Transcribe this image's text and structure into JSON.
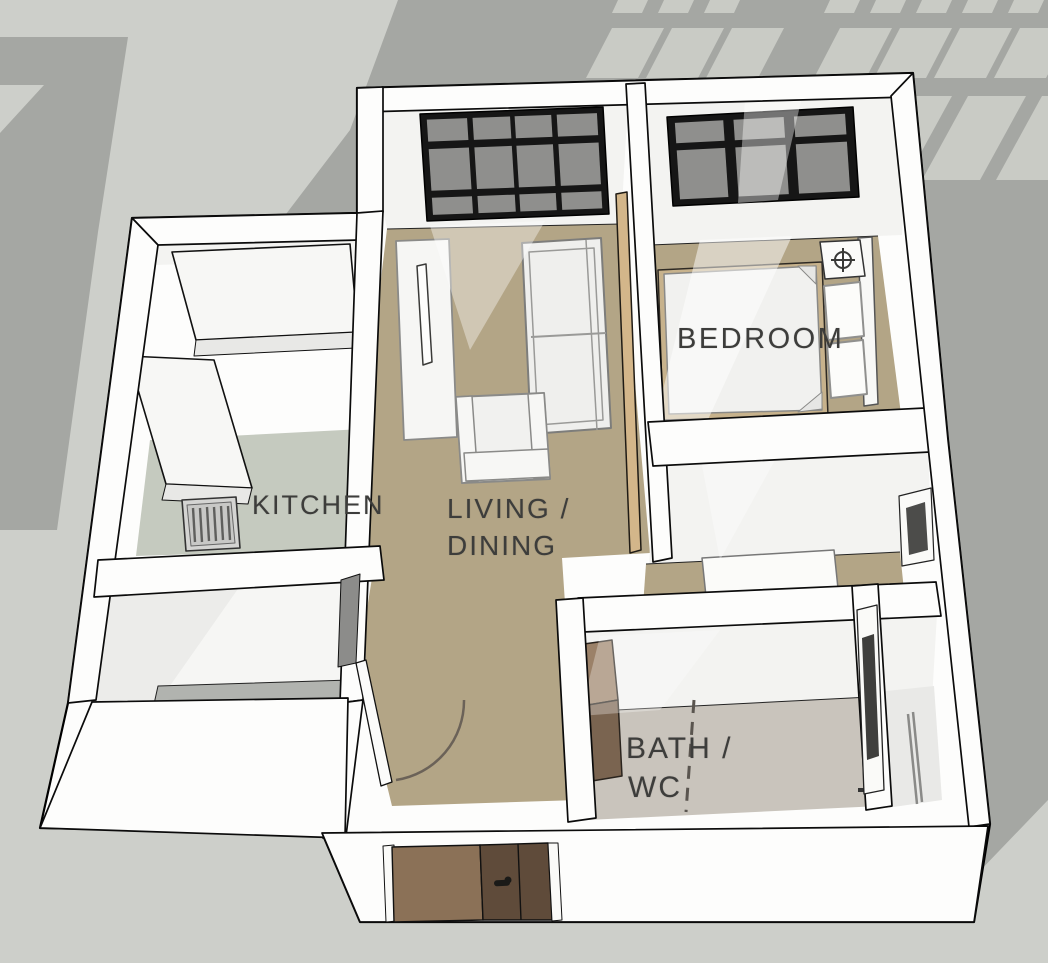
{
  "labels": {
    "kitchen": "KITCHEN",
    "living_line1": "LIVING /",
    "living_line2": "DINING",
    "bedroom": "BEDROOM",
    "bath_line1": "BATH /",
    "bath_line2": "WC"
  },
  "colors": {
    "background": "#cdcfca",
    "shadow_gray": "#a5a7a3",
    "slash_light": "#c9cbc5",
    "wall_white": "#fdfdfc",
    "wall_face": "#f3f3f1",
    "floor_living": "#b3a586",
    "floor_bedroom": "#b3a586",
    "floor_hall": "#b3a586",
    "floor_kitchen": "#c5cabf",
    "floor_bath": "#c9c4bc",
    "window_frame": "#161616",
    "window_glass": "#8f8f8d",
    "door_leaf_light": "#8b7157",
    "door_leaf_dark": "#5f4b3a",
    "sliding_door_wood": "#d3b68a",
    "vanity_wood_top": "#9b8168",
    "vanity_wood_side": "#7a6450",
    "label_text": "#3d3d3b"
  },
  "windows": {
    "living": {
      "corners": [
        [
          420,
          114
        ],
        [
          603,
          107
        ],
        [
          609,
          214
        ],
        [
          427,
          221
        ]
      ],
      "cols": [
        [
          0.035,
          0.255
        ],
        [
          0.285,
          0.49
        ],
        [
          0.515,
          0.715
        ],
        [
          0.745,
          0.965
        ]
      ],
      "rows": [
        [
          0.055,
          0.26
        ],
        [
          0.33,
          0.72
        ],
        [
          0.785,
          0.945
        ]
      ]
    },
    "bedroom": {
      "corners": [
        [
          667,
          117
        ],
        [
          853,
          107
        ],
        [
          859,
          197
        ],
        [
          673,
          206
        ]
      ],
      "cols": [
        [
          0.04,
          0.3
        ],
        [
          0.355,
          0.625
        ],
        [
          0.68,
          0.955
        ]
      ],
      "rows": [
        [
          0.07,
          0.3
        ],
        [
          0.38,
          0.93
        ]
      ]
    }
  },
  "slashes": [
    {
      "x": 618,
      "y": 0,
      "w": 30,
      "h": 13,
      "s": 6
    },
    {
      "x": 664,
      "y": 0,
      "w": 30,
      "h": 13,
      "s": 6
    },
    {
      "x": 710,
      "y": 0,
      "w": 30,
      "h": 13,
      "s": 6
    },
    {
      "x": 830,
      "y": 0,
      "w": 30,
      "h": 13,
      "s": 6
    },
    {
      "x": 876,
      "y": 0,
      "w": 30,
      "h": 13,
      "s": 6
    },
    {
      "x": 922,
      "y": 0,
      "w": 30,
      "h": 13,
      "s": 6
    },
    {
      "x": 968,
      "y": 0,
      "w": 30,
      "h": 13,
      "s": 6
    },
    {
      "x": 1014,
      "y": 0,
      "w": 30,
      "h": 13,
      "s": 6
    },
    {
      "x": 612,
      "y": 28,
      "w": 52,
      "h": 50,
      "s": 26
    },
    {
      "x": 672,
      "y": 28,
      "w": 52,
      "h": 50,
      "s": 26
    },
    {
      "x": 732,
      "y": 28,
      "w": 52,
      "h": 50,
      "s": 26
    },
    {
      "x": 840,
      "y": 28,
      "w": 52,
      "h": 50,
      "s": 26
    },
    {
      "x": 900,
      "y": 28,
      "w": 52,
      "h": 50,
      "s": 26
    },
    {
      "x": 960,
      "y": 28,
      "w": 52,
      "h": 50,
      "s": 26
    },
    {
      "x": 1020,
      "y": 28,
      "w": 52,
      "h": 50,
      "s": 26
    },
    {
      "x": 820,
      "y": 96,
      "w": 58,
      "h": 84,
      "s": 46
    },
    {
      "x": 894,
      "y": 96,
      "w": 58,
      "h": 84,
      "s": 46
    },
    {
      "x": 968,
      "y": 96,
      "w": 58,
      "h": 84,
      "s": 46
    },
    {
      "x": 1042,
      "y": 96,
      "w": 58,
      "h": 84,
      "s": 46
    }
  ]
}
